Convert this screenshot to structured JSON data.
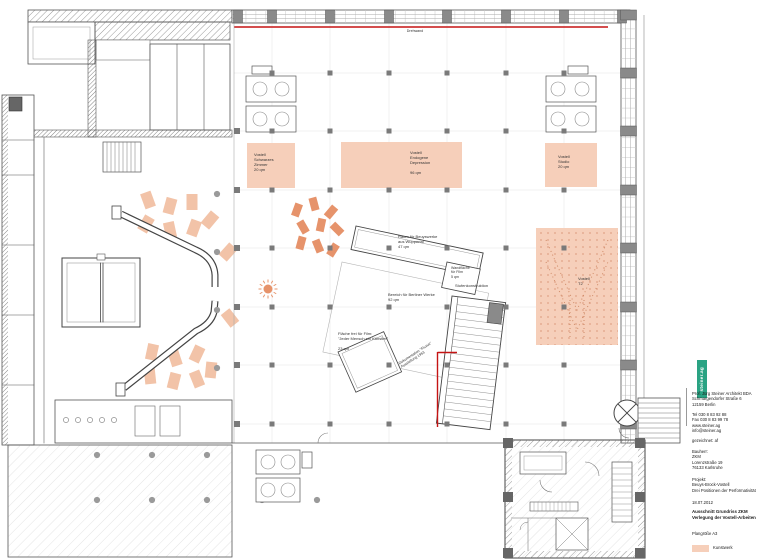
{
  "colors": {
    "artwork_pink": "#f6cfba",
    "table_orange": "#e6936b",
    "accent_red": "#c51414",
    "logo_green": "#2aa383"
  },
  "plan": {
    "top_label": "Drehwand",
    "areas": {
      "schwarzes_zimmer": "Vostell\nSchwarzes\nZimmer\n20 qm",
      "endogene_depression": "Vostell\nEndogene\nDepression\n\n96 qm",
      "studio": "Vostell\nStudio\n20 qm",
      "t2": "Vostell\nT2"
    },
    "labels": {
      "beuyswerke": "Raum für Beuyswerke\naus Wuppertal\n47 qm",
      "wandflaeche": "Wandfläche\nfür Film\n5 qm",
      "berliner": "Bereich für Berliner Werke\n92 qm",
      "stufen": "Stufenkonstruktion",
      "film": "Fläche frei für Film:\n\"Jeder Mensch ein Künstler\"\n\n23 qm",
      "doku": "Dokumentation \"Fluxus\"\nAusstellung 1963"
    }
  },
  "titleblock": {
    "logo": "steiner.ag",
    "architect": "Prof. Jürg Steiner Architekt BDA\nSchmargendorfer Straße 6\n12159 Berlin",
    "contact": "Tel 030 8 83 92 88\nFax 030 8 83 99 78\nwww.steiner.ag\ninfo@steiner.ag",
    "drawn": "gezeichnet: af",
    "client": "Bauherr:\nZKM\nLorenzstraße 19\n76133 Karlsruhe",
    "project": "Projekt:\nBeuys-Brock-Vostell\nDrei Positionen der Performativität",
    "date": "18.07.2012",
    "title": "Ausschnitt Grundriss ZKM\nVerlegung der Vostell-Arbeiten",
    "sheet": "Plangröße A3",
    "legend": "Kunstwerk"
  }
}
